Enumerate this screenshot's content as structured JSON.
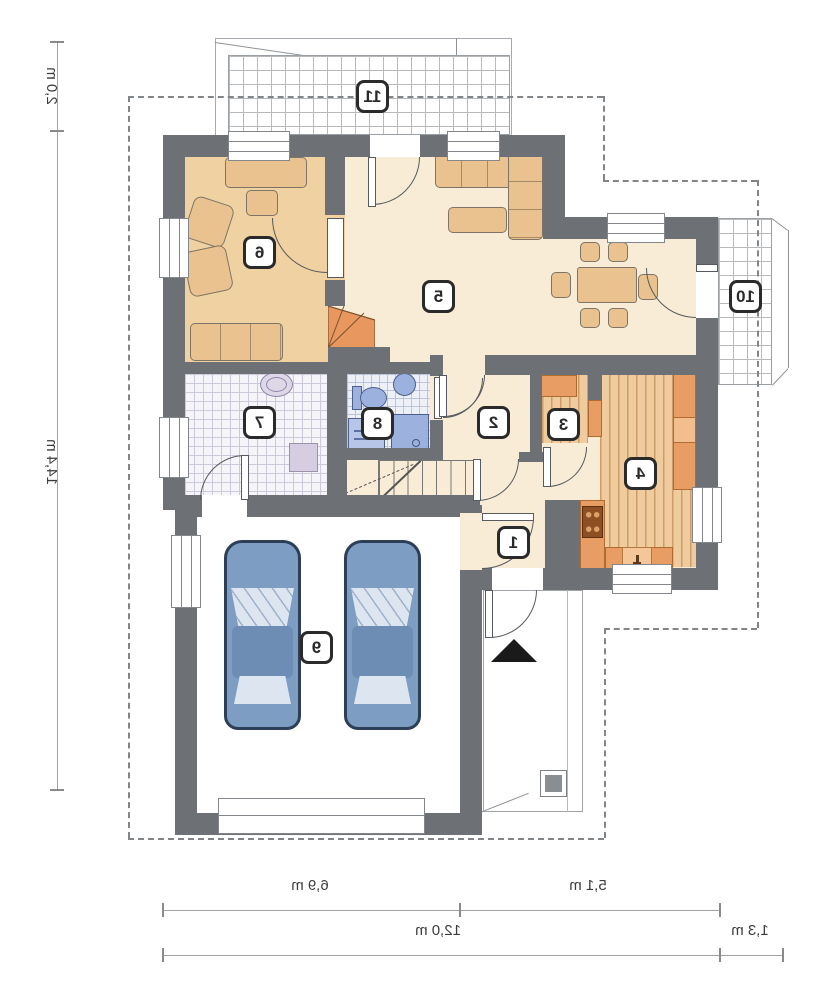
{
  "plan": {
    "type": "residential-floor-plan",
    "mirrored_text": true,
    "rooms": [
      {
        "number": "1"
      },
      {
        "number": "2"
      },
      {
        "number": "3"
      },
      {
        "number": "4"
      },
      {
        "number": "5"
      },
      {
        "number": "6"
      },
      {
        "number": "7"
      },
      {
        "number": "8"
      },
      {
        "number": "9"
      },
      {
        "number": "10"
      },
      {
        "number": "11"
      }
    ],
    "dimensions": {
      "left_upper": "2,0 m",
      "left_main": "14,4 m",
      "bottom_left": "6,9 m",
      "bottom_right": "5,1 m",
      "bottom_total": "12,0 m",
      "bottom_offset": "1,3 m"
    },
    "colors": {
      "wall": "#6d7175",
      "floor_cream": "#f8ecd6",
      "floor_tan": "#f0d2a2",
      "floor_wood": "#efcb9e",
      "counter_orange": "#e79d63",
      "stair_orange": "#e8985f",
      "fixture_blue": "#9db1de",
      "car_blue": "#7e9dc2",
      "grid_gray": "#b6babd",
      "badge_border": "#2a2a2a"
    }
  }
}
